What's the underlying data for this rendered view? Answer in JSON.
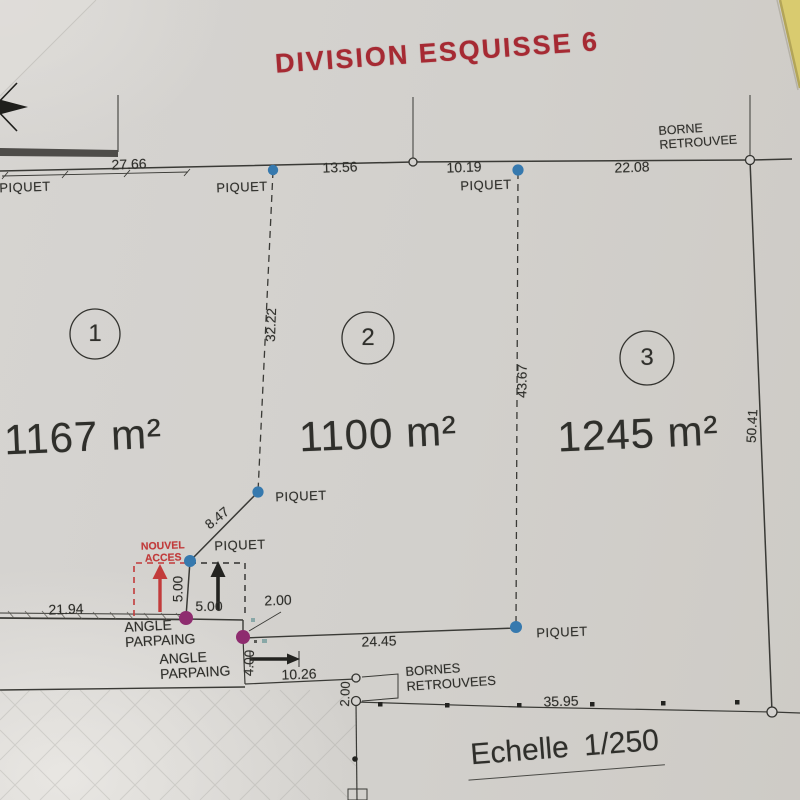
{
  "title": "DIVISION ESQUISSE 6",
  "scale": {
    "label": "Echelle 1/250"
  },
  "parcels": [
    {
      "number": "1",
      "area": "1167 m²"
    },
    {
      "number": "2",
      "area": "1100 m²"
    },
    {
      "number": "3",
      "area": "1245 m²"
    }
  ],
  "markers": {
    "piquet": "PIQUET",
    "borne_retrouvee": [
      "BORNE",
      "RETROUVEE"
    ],
    "bornes_retrouvees": [
      "BORNES",
      "RETROUVEES"
    ],
    "angle_parpaing": [
      "ANGLE",
      "PARPAING"
    ],
    "nouvel_acces": [
      "NOUVEL",
      "ACCES"
    ]
  },
  "dimensions": {
    "top_1": "27.66",
    "top_2": "13.56",
    "top_3": "10.19",
    "top_4": "22.08",
    "divider_1_2": "32.22",
    "divider_2_3": "43.67",
    "east_side": "50.41",
    "diagonal": "8.47",
    "access_vertical": "5.00",
    "access_horizontal": "5.00",
    "access_offset": "2.00",
    "west_low": "21.94",
    "parcel2_south": "24.45",
    "lower_width": "10.26",
    "lower_height": "4.00",
    "borne_gap": "2.00",
    "south": "35.95"
  },
  "colors": {
    "title_red": "#a62a33",
    "piquet_dot_blue": "#3679ae",
    "corner_dot_purple": "#8e2c6f",
    "access_arrow_red": "#c23b3b",
    "paper_gray": "#d4d2cf",
    "desk_yellow": "#d9cb6f",
    "line_dark": "#3a3a36"
  }
}
